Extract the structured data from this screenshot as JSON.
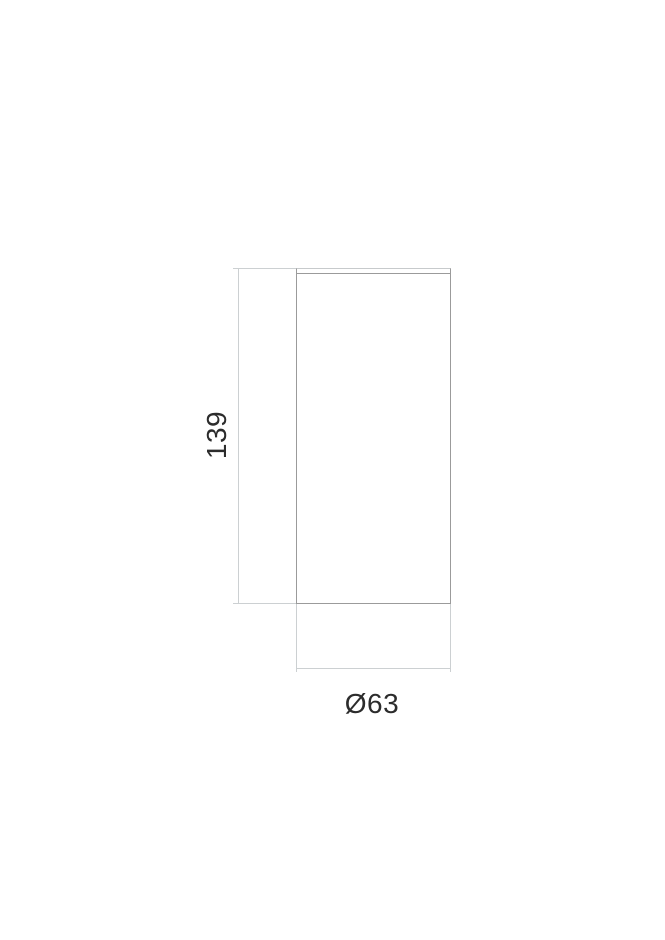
{
  "drawing": {
    "kind": "technical-dimension-drawing",
    "view": "cylinder-side-view",
    "height_dimension": {
      "label": "139"
    },
    "diameter_dimension": {
      "label": "Ø63"
    }
  },
  "colors": {
    "background": "#ffffff",
    "outline": "#9b9b9b",
    "outline-light": "#c7cacc",
    "dimension": "#ccd0d2",
    "text": "#2c2c2c"
  }
}
